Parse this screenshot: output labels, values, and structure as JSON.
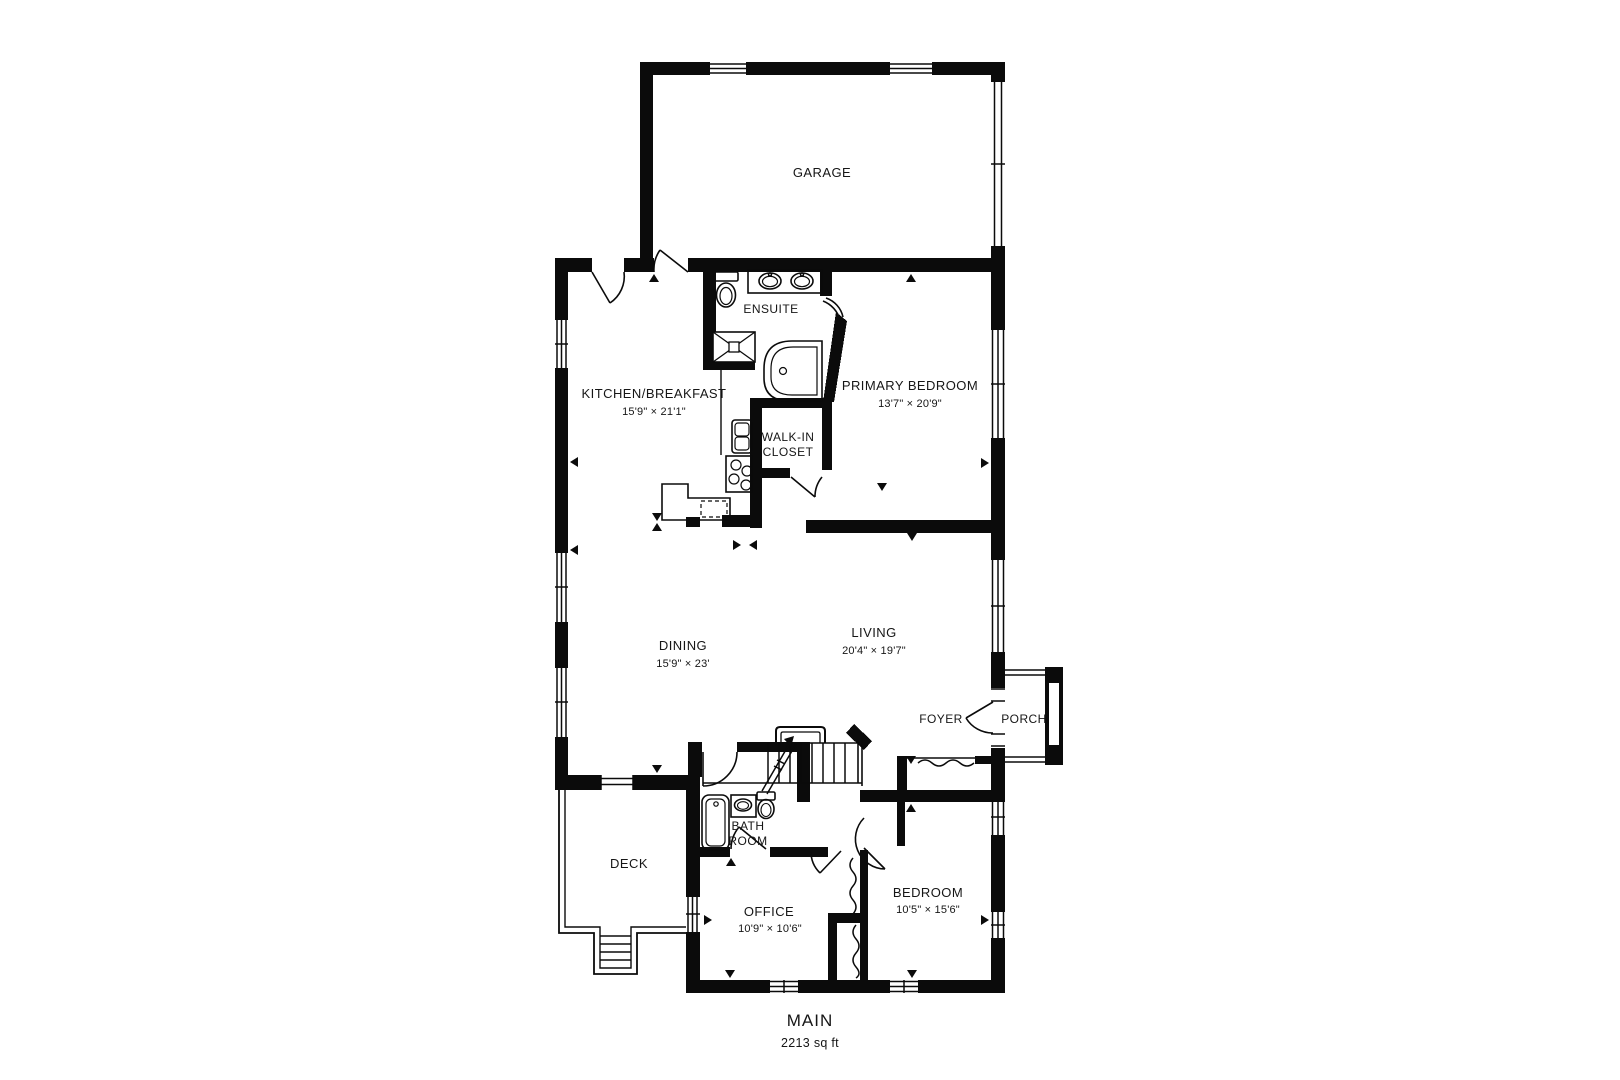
{
  "colors": {
    "walls": "#0b0b0b",
    "background": "#ffffff",
    "text": "#161616"
  },
  "plan": {
    "floor_title": "MAIN",
    "floor_area": "2213 sq ft"
  },
  "rooms": {
    "garage": {
      "name": "GARAGE"
    },
    "ensuite": {
      "name": "ENSUITE"
    },
    "kitchen": {
      "name": "KITCHEN/BREAKFAST",
      "dims": "15'9\" × 21'1\""
    },
    "walk_in_closet": {
      "line1": "WALK-IN",
      "line2": "CLOSET"
    },
    "primary_bedroom": {
      "name": "PRIMARY BEDROOM",
      "dims": "13'7\" × 20'9\""
    },
    "dining": {
      "name": "DINING",
      "dims": "15'9\" × 23'"
    },
    "living": {
      "name": "LIVING",
      "dims": "20'4\" × 19'7\""
    },
    "foyer": {
      "name": "FOYER"
    },
    "porch": {
      "name": "PORCH"
    },
    "bathroom": {
      "line1": "BATH",
      "line2": "ROOM"
    },
    "deck": {
      "name": "DECK"
    },
    "office": {
      "name": "OFFICE",
      "dims": "10'9\" × 10'6\""
    },
    "bedroom": {
      "name": "BEDROOM",
      "dims": "10'5\" × 15'6\""
    }
  }
}
